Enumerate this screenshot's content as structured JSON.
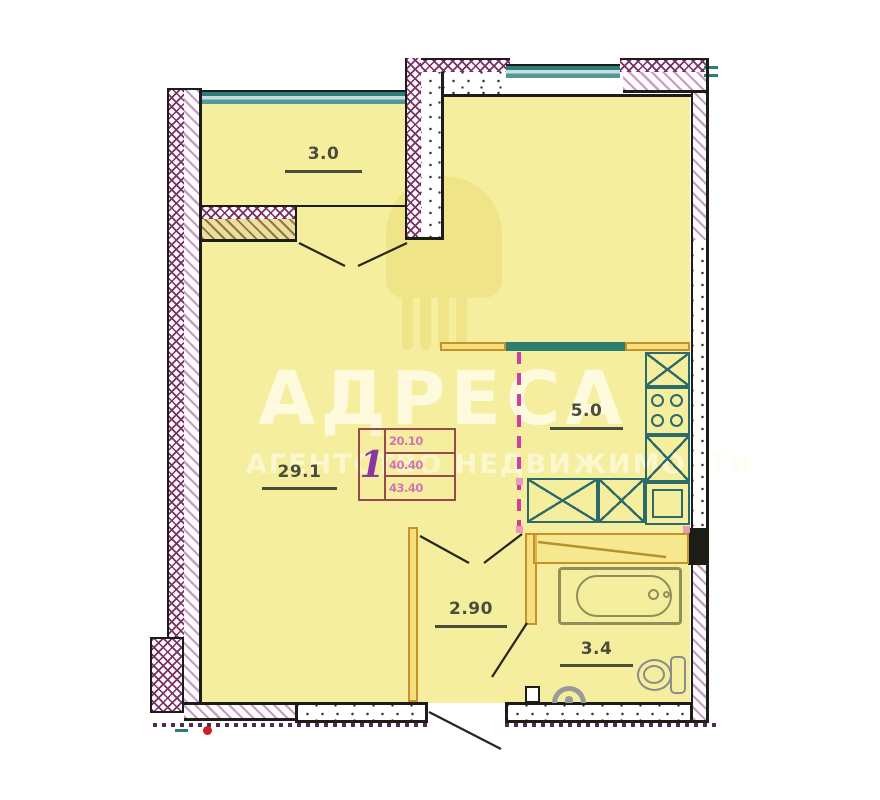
{
  "watermark": {
    "brand": "АДРЕСА",
    "subtitle": "АГЕНТСТВО НЕДВИЖИМОСТИ"
  },
  "rooms": [
    {
      "name": "balcony",
      "area": "3.0"
    },
    {
      "name": "living-room",
      "area": "29.1"
    },
    {
      "name": "kitchen",
      "area": "5.0"
    },
    {
      "name": "hallway",
      "area": "2.90"
    },
    {
      "name": "bathroom",
      "area": "3.4"
    }
  ],
  "info_box": {
    "rooms_count": "1",
    "values": [
      "20.10",
      "40.40",
      "43.40"
    ]
  },
  "fixtures": [
    "kitchen-counter",
    "stove",
    "kitchen-sink",
    "bathtub",
    "toilet",
    "washbasin"
  ],
  "colors": {
    "floor": "#f4ee9e",
    "wall_cross_hatch": "#7a2f63",
    "wall_diag_hatch": "#c49fc2",
    "window_teal": "#2e7d7d",
    "partition_orange": "#c8922a",
    "fixture_teal": "#2d6b6b",
    "zone_dashed_magenta": "#d63ca0",
    "bottom_dotted_purple": "#55275c",
    "marker_red": "#cc2020",
    "info_numbers_pink": "#d473b5",
    "info_rooms_purple": "#8b35a0"
  }
}
